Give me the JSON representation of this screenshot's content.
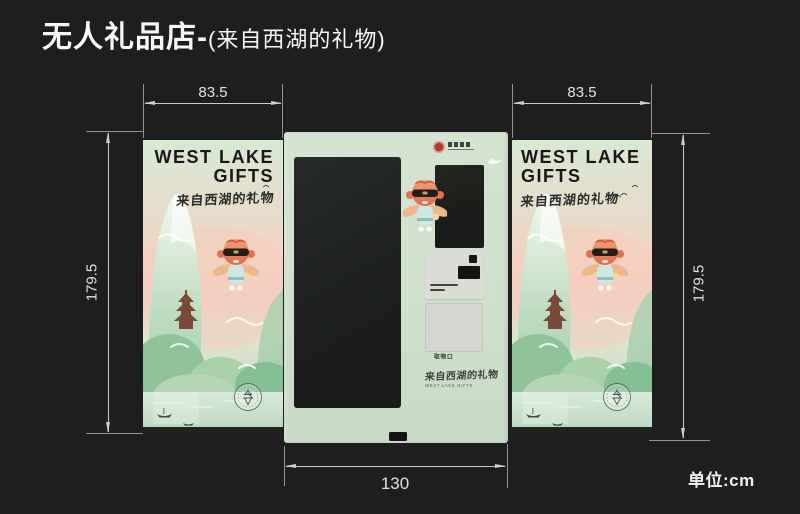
{
  "header": {
    "title_main": "无人礼品店-",
    "title_sub": "(来自西湖的礼物)"
  },
  "annotations": {
    "dim_left_panel_width": "83.5",
    "dim_right_panel_width": "83.5",
    "dim_left_height": "179.5",
    "dim_right_height": "179.5",
    "dim_machine_width": "130",
    "unit_label": "单位:cm"
  },
  "poster": {
    "title_line1": "WEST LAKE",
    "title_line2": "GIFTS",
    "subtitle": "来自西湖的礼物"
  },
  "machine": {
    "pickup_door_label": "取物口",
    "slogan": "来自西湖的礼物",
    "slogan_caption": "WEST LAKE GIFTS"
  },
  "icons": {
    "brand_seal": "red-seal-circle",
    "swan": "white-swan",
    "camera": "camera-square",
    "qr_scanner": "scanner-slot",
    "lock": "base-lock",
    "stamp": "pagoda-round-stamp",
    "mascot": "flying-fish-mascot"
  },
  "colors": {
    "background": "#1d1e1d",
    "machine_body": "#cfe0cc",
    "dimension_line": "#cdcdcd",
    "poster_text": "#171717",
    "seal_red": "#b23a2e"
  }
}
